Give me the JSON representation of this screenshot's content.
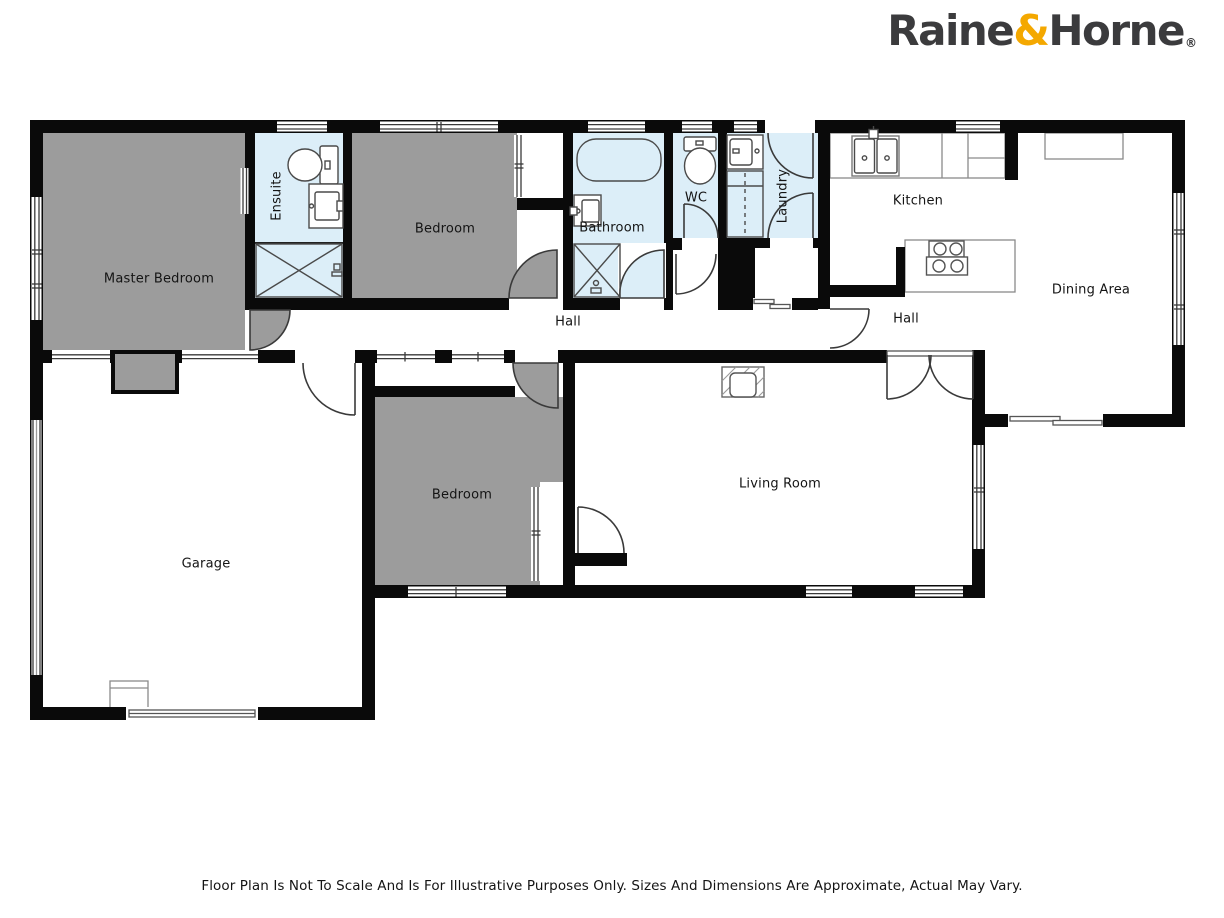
{
  "brand": {
    "name_first": "Raine",
    "ampersand": "&",
    "name_second": "Horne",
    "registered_mark": "®"
  },
  "rooms": [
    {
      "id": "master-bedroom",
      "label": "Master Bedroom"
    },
    {
      "id": "ensuite",
      "label": "Ensuite"
    },
    {
      "id": "bedroom-top",
      "label": "Bedroom"
    },
    {
      "id": "bathroom",
      "label": "Bathroom"
    },
    {
      "id": "wc",
      "label": "WC"
    },
    {
      "id": "laundry",
      "label": "Laundry"
    },
    {
      "id": "kitchen",
      "label": "Kitchen"
    },
    {
      "id": "hall-west",
      "label": "Hall"
    },
    {
      "id": "hall-east",
      "label": "Hall"
    },
    {
      "id": "dining-area",
      "label": "Dining Area"
    },
    {
      "id": "living-room",
      "label": "Living Room"
    },
    {
      "id": "bedroom-bottom",
      "label": "Bedroom"
    },
    {
      "id": "garage",
      "label": "Garage"
    }
  ],
  "disclaimer": "Floor Plan Is Not To Scale And Is For Illustrative Purposes Only. Sizes And Dimensions Are Approximate, Actual May Vary.",
  "colors": {
    "wall": "#0a0a0a",
    "bedroom_fill": "#9c9c9c",
    "wet_area_fill": "#dceef8",
    "logo_text": "#3b3b3d",
    "logo_ampersand": "#f4a800"
  },
  "fixtures": [
    "toilet-icon",
    "bathtub-icon",
    "shower-icon",
    "vanity-sink-icon",
    "laundry-tub-icon",
    "washer-space-icon",
    "kitchen-sink-icon",
    "cooktop-icon",
    "kitchen-island",
    "kitchen-counter",
    "buffet-counter",
    "fireplace-icon",
    "water-heater-icon",
    "wardrobe-icon",
    "door-swing-icon",
    "window-icon",
    "sliding-door-icon"
  ]
}
